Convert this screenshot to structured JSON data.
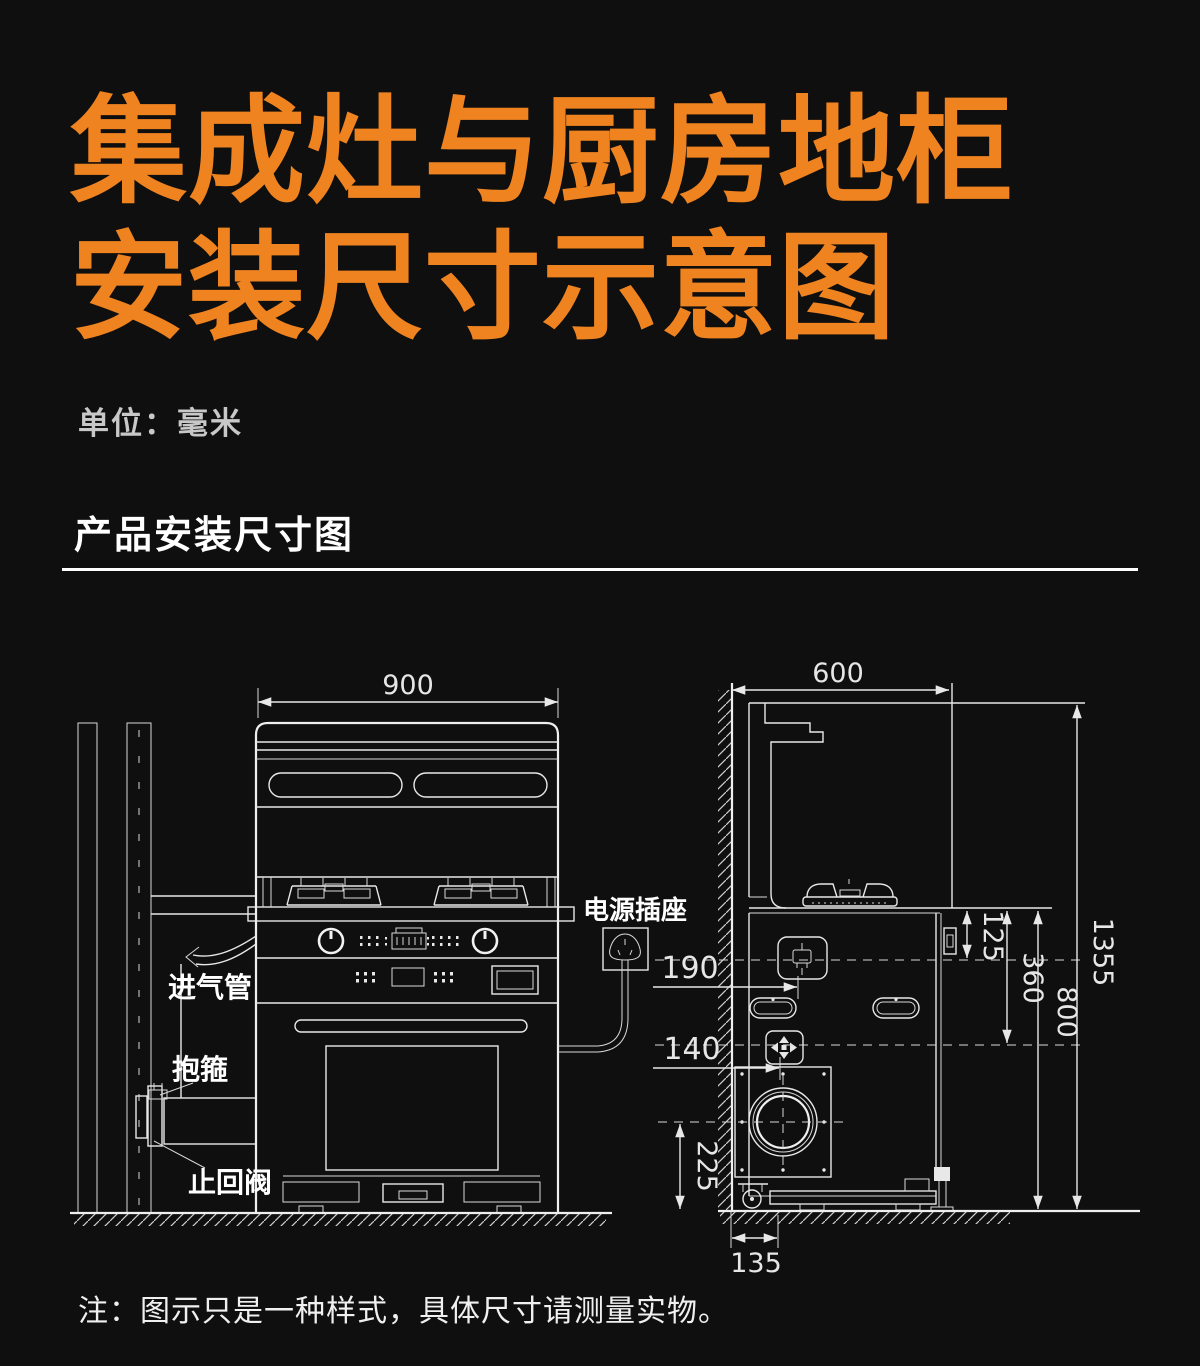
{
  "page": {
    "background": "#0f0f0f",
    "accent_orange": "#EF8320",
    "line_color": "#E8E8E8"
  },
  "header": {
    "title_line1": "集成灶与厨房地柜",
    "title_line2": "安装尺寸示意图",
    "unit_label": "单位：毫米",
    "section_title": "产品安装尺寸图"
  },
  "diagram": {
    "front_view": {
      "width_mm": "900",
      "power_socket_label": "电源插座",
      "gas_inlet_label": "进气管",
      "clamp_label": "抱箍",
      "check_valve_label": "止回阀"
    },
    "side_view": {
      "depth_mm": "600",
      "total_height_mm": "1355",
      "counter_height_mm": "800",
      "socket_drop_mm": "125",
      "valve_drop_mm": "360",
      "socket_wall_offset_mm": "190",
      "valve_wall_offset_mm": "140",
      "outlet_center_height_mm": "225",
      "outlet_wall_offset_mm": "135"
    },
    "icons": {
      "power_plug": "three-pin-plug",
      "wall_socket": "socket-with-plug",
      "gas_valve": "cross-arrow-valve",
      "exhaust_outlet": "circular-flange"
    }
  },
  "footer": {
    "note": "注：图示只是一种样式，具体尺寸请测量实物。"
  }
}
